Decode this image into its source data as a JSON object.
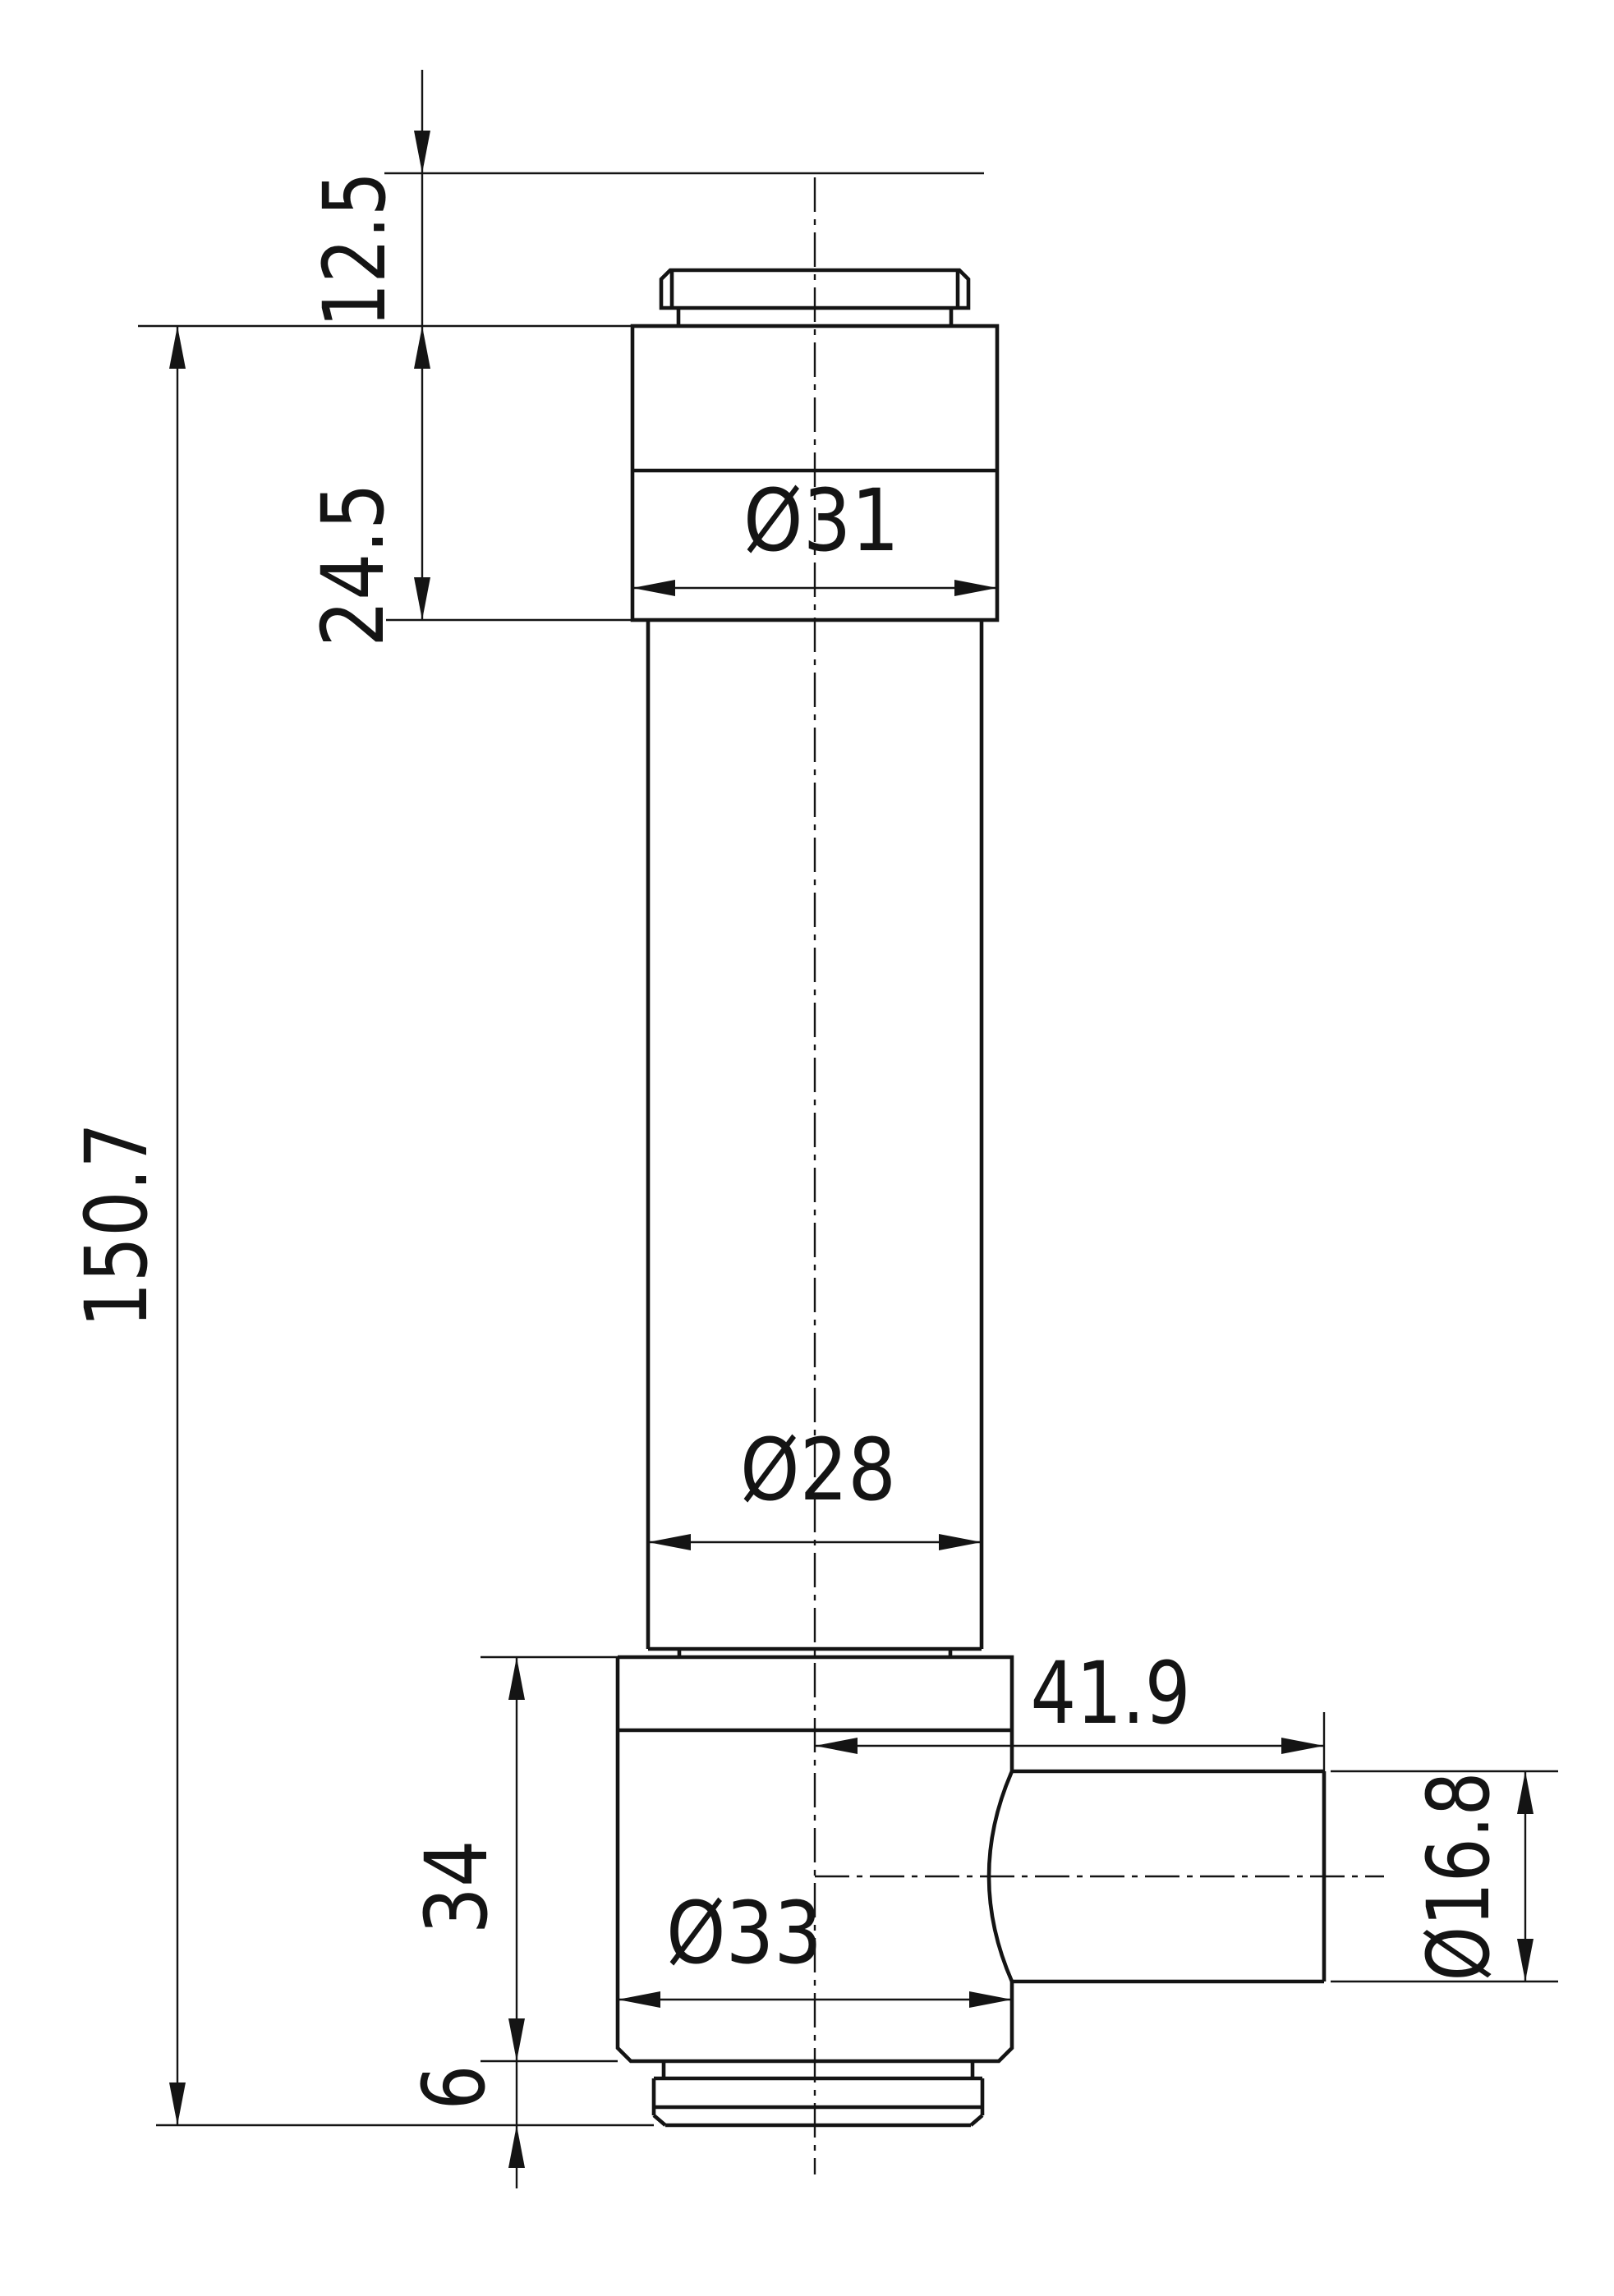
{
  "drawing": {
    "title": "valve-body-orthographic-section",
    "line_color": "#141414",
    "background": "#ffffff",
    "dimensions": {
      "ref_top_offset": {
        "label": "12.5",
        "value_mm": 12.5,
        "orientation": "vertical"
      },
      "head_height": {
        "label": "24.5",
        "value_mm": 24.5,
        "orientation": "vertical"
      },
      "overall_height": {
        "label": "150.7",
        "value_mm": 150.7,
        "orientation": "vertical"
      },
      "head_diameter": {
        "label": "Ø31",
        "value_mm": 31,
        "orientation": "horizontal"
      },
      "stem_diameter": {
        "label": "Ø28",
        "value_mm": 28,
        "orientation": "horizontal"
      },
      "port_length": {
        "label": "41.9",
        "value_mm": 41.9,
        "orientation": "horizontal"
      },
      "body_height": {
        "label": "34",
        "value_mm": 34,
        "orientation": "vertical"
      },
      "body_diameter": {
        "label": "Ø33",
        "value_mm": 33,
        "orientation": "horizontal"
      },
      "port_diameter": {
        "label": "Ø16.8",
        "value_mm": 16.8,
        "orientation": "vertical"
      },
      "flange_height": {
        "label": "6",
        "value_mm": 6,
        "orientation": "vertical"
      }
    }
  }
}
